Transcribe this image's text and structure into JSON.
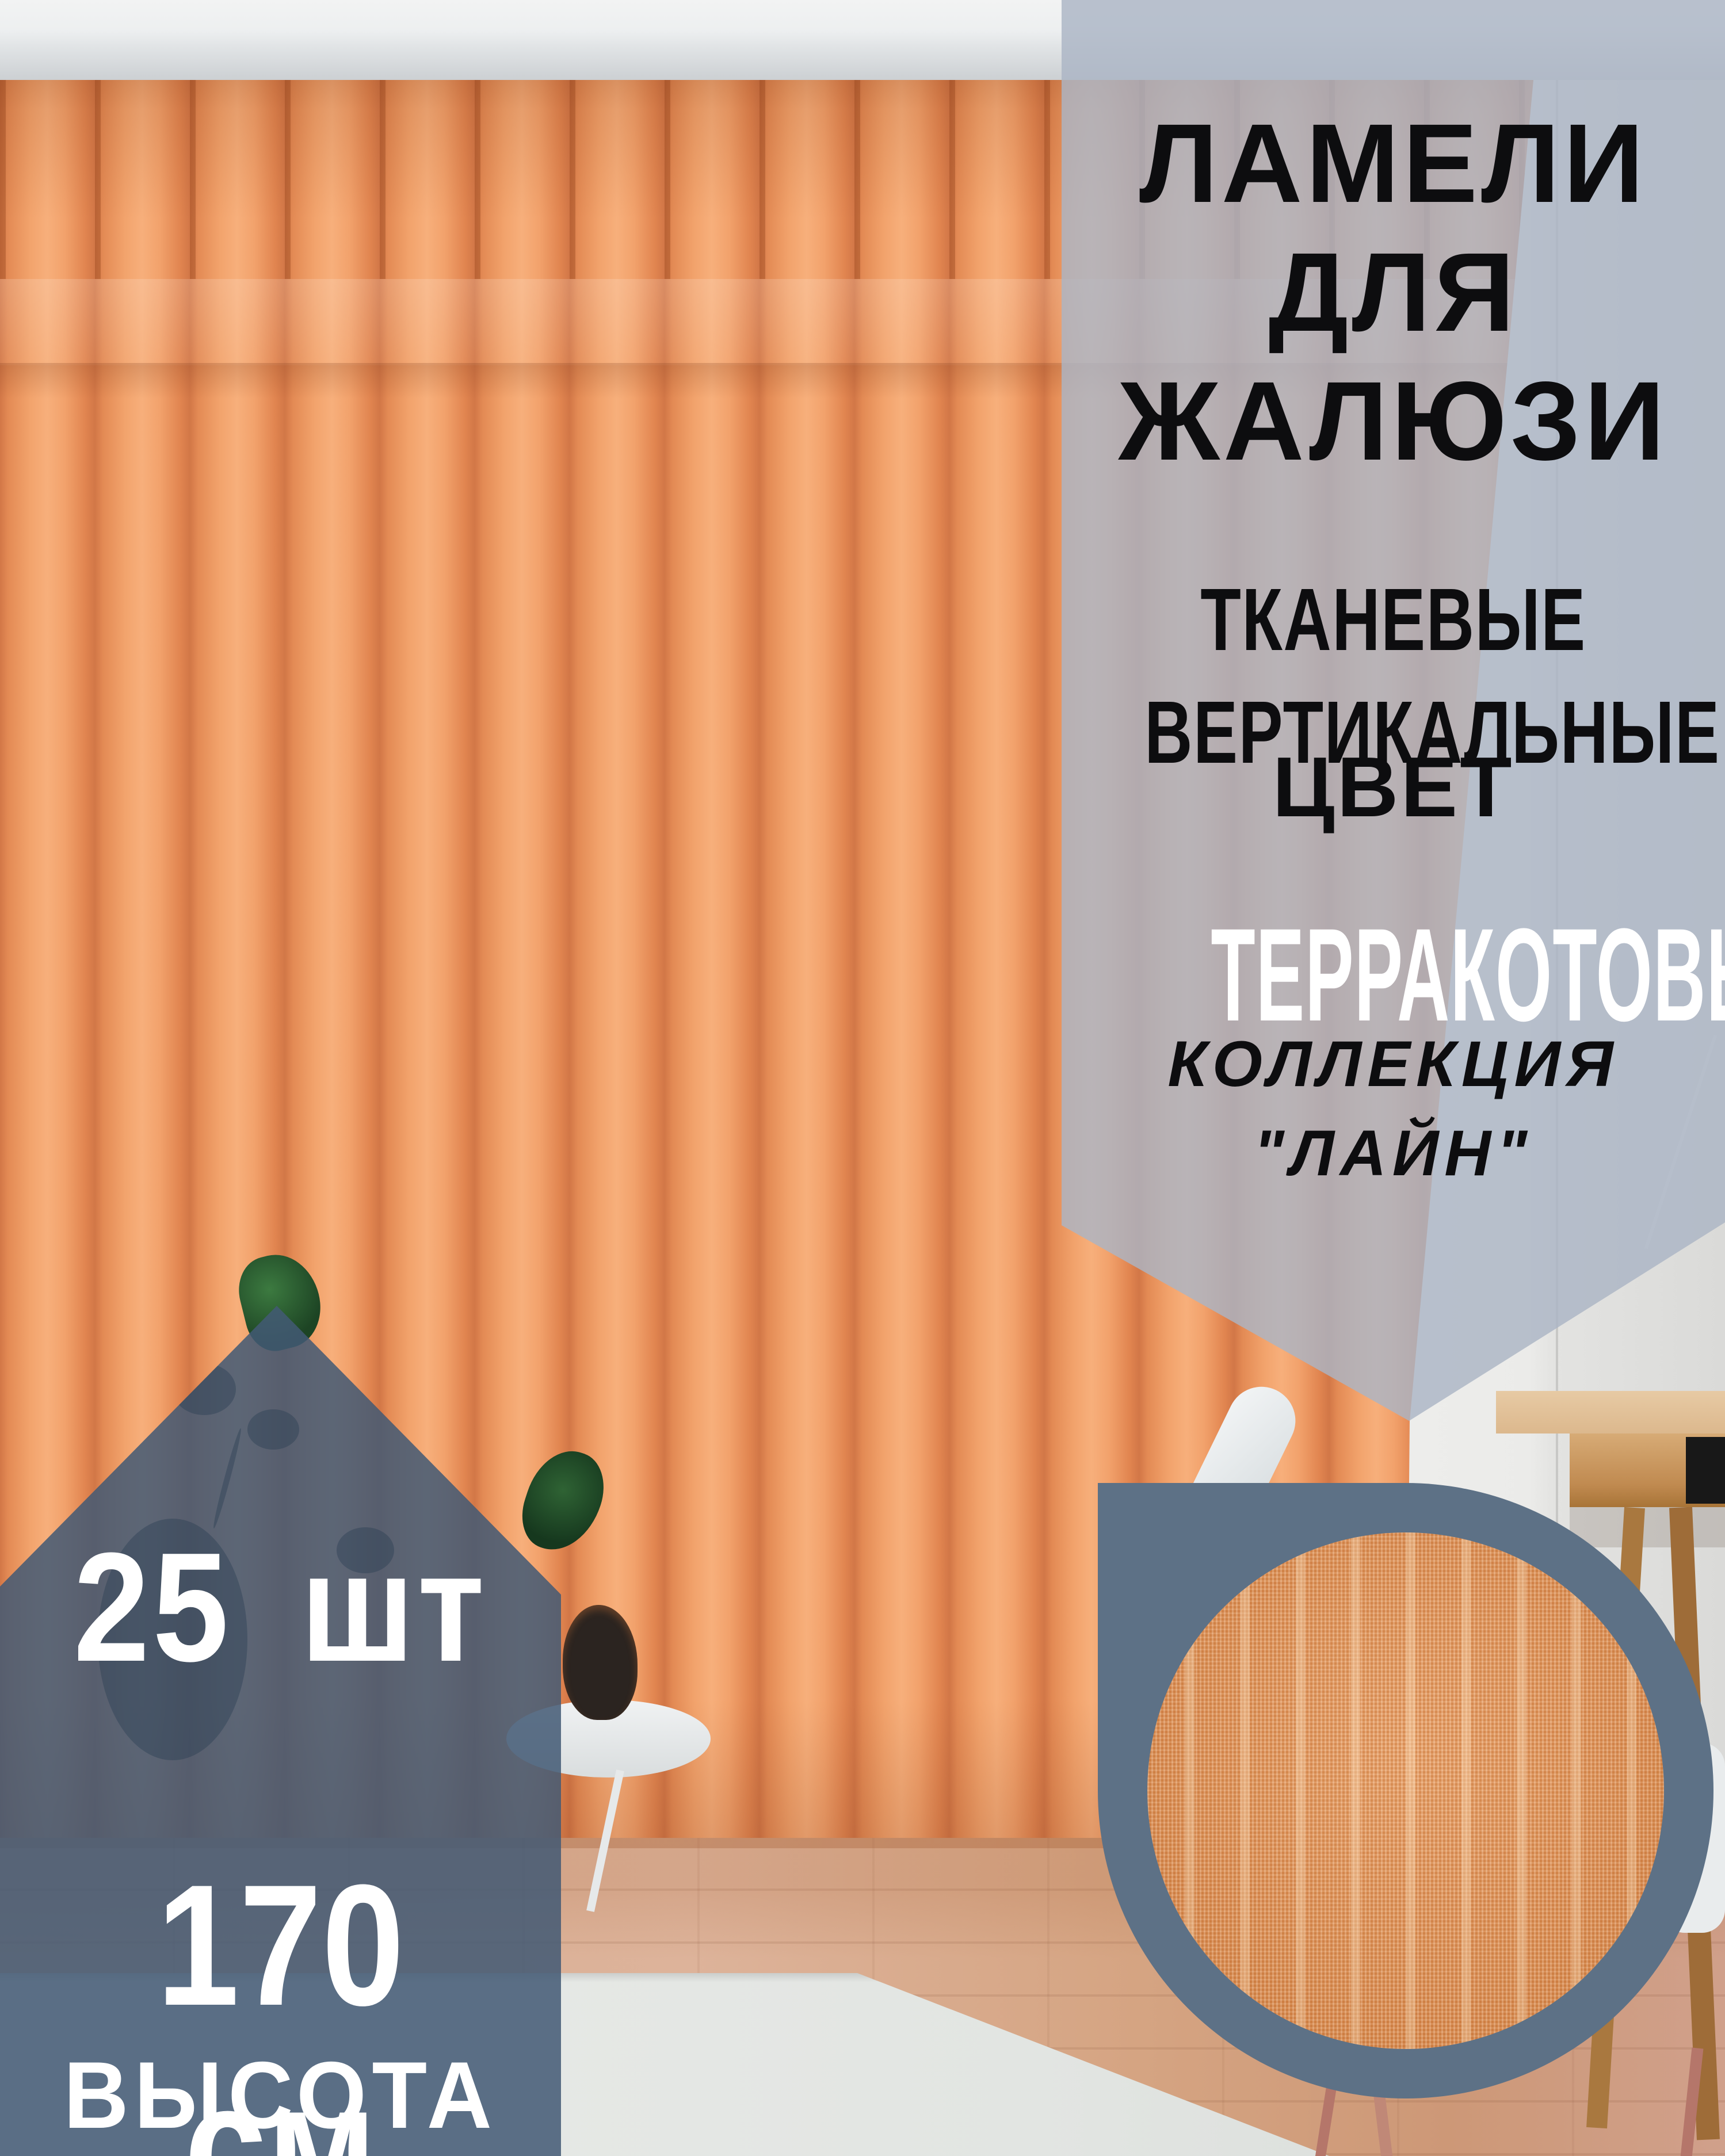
{
  "card": {
    "headline": {
      "line1": "ЛАМЕЛИ",
      "line2": "ДЛЯ",
      "line3": "ЖАЛЮЗИ"
    },
    "material": {
      "line1": "ТКАНЕВЫЕ",
      "line2": "ВЕРТИКАЛЬНЫЕ"
    },
    "color": {
      "label": "ЦВЕТ",
      "value": "ТЕРРАКОТОВЫЙ"
    },
    "collection": {
      "label": "КОЛЛЕКЦИЯ",
      "value": "\"ЛАЙН\""
    },
    "quantity": "25 шт",
    "height_value": "170 см",
    "height_label": "ВЫСОТА"
  },
  "colors": {
    "badge_slate": "#5d7186",
    "panel_gray": "#b5bdc9",
    "blinds_terracotta": "#ef9c66"
  }
}
